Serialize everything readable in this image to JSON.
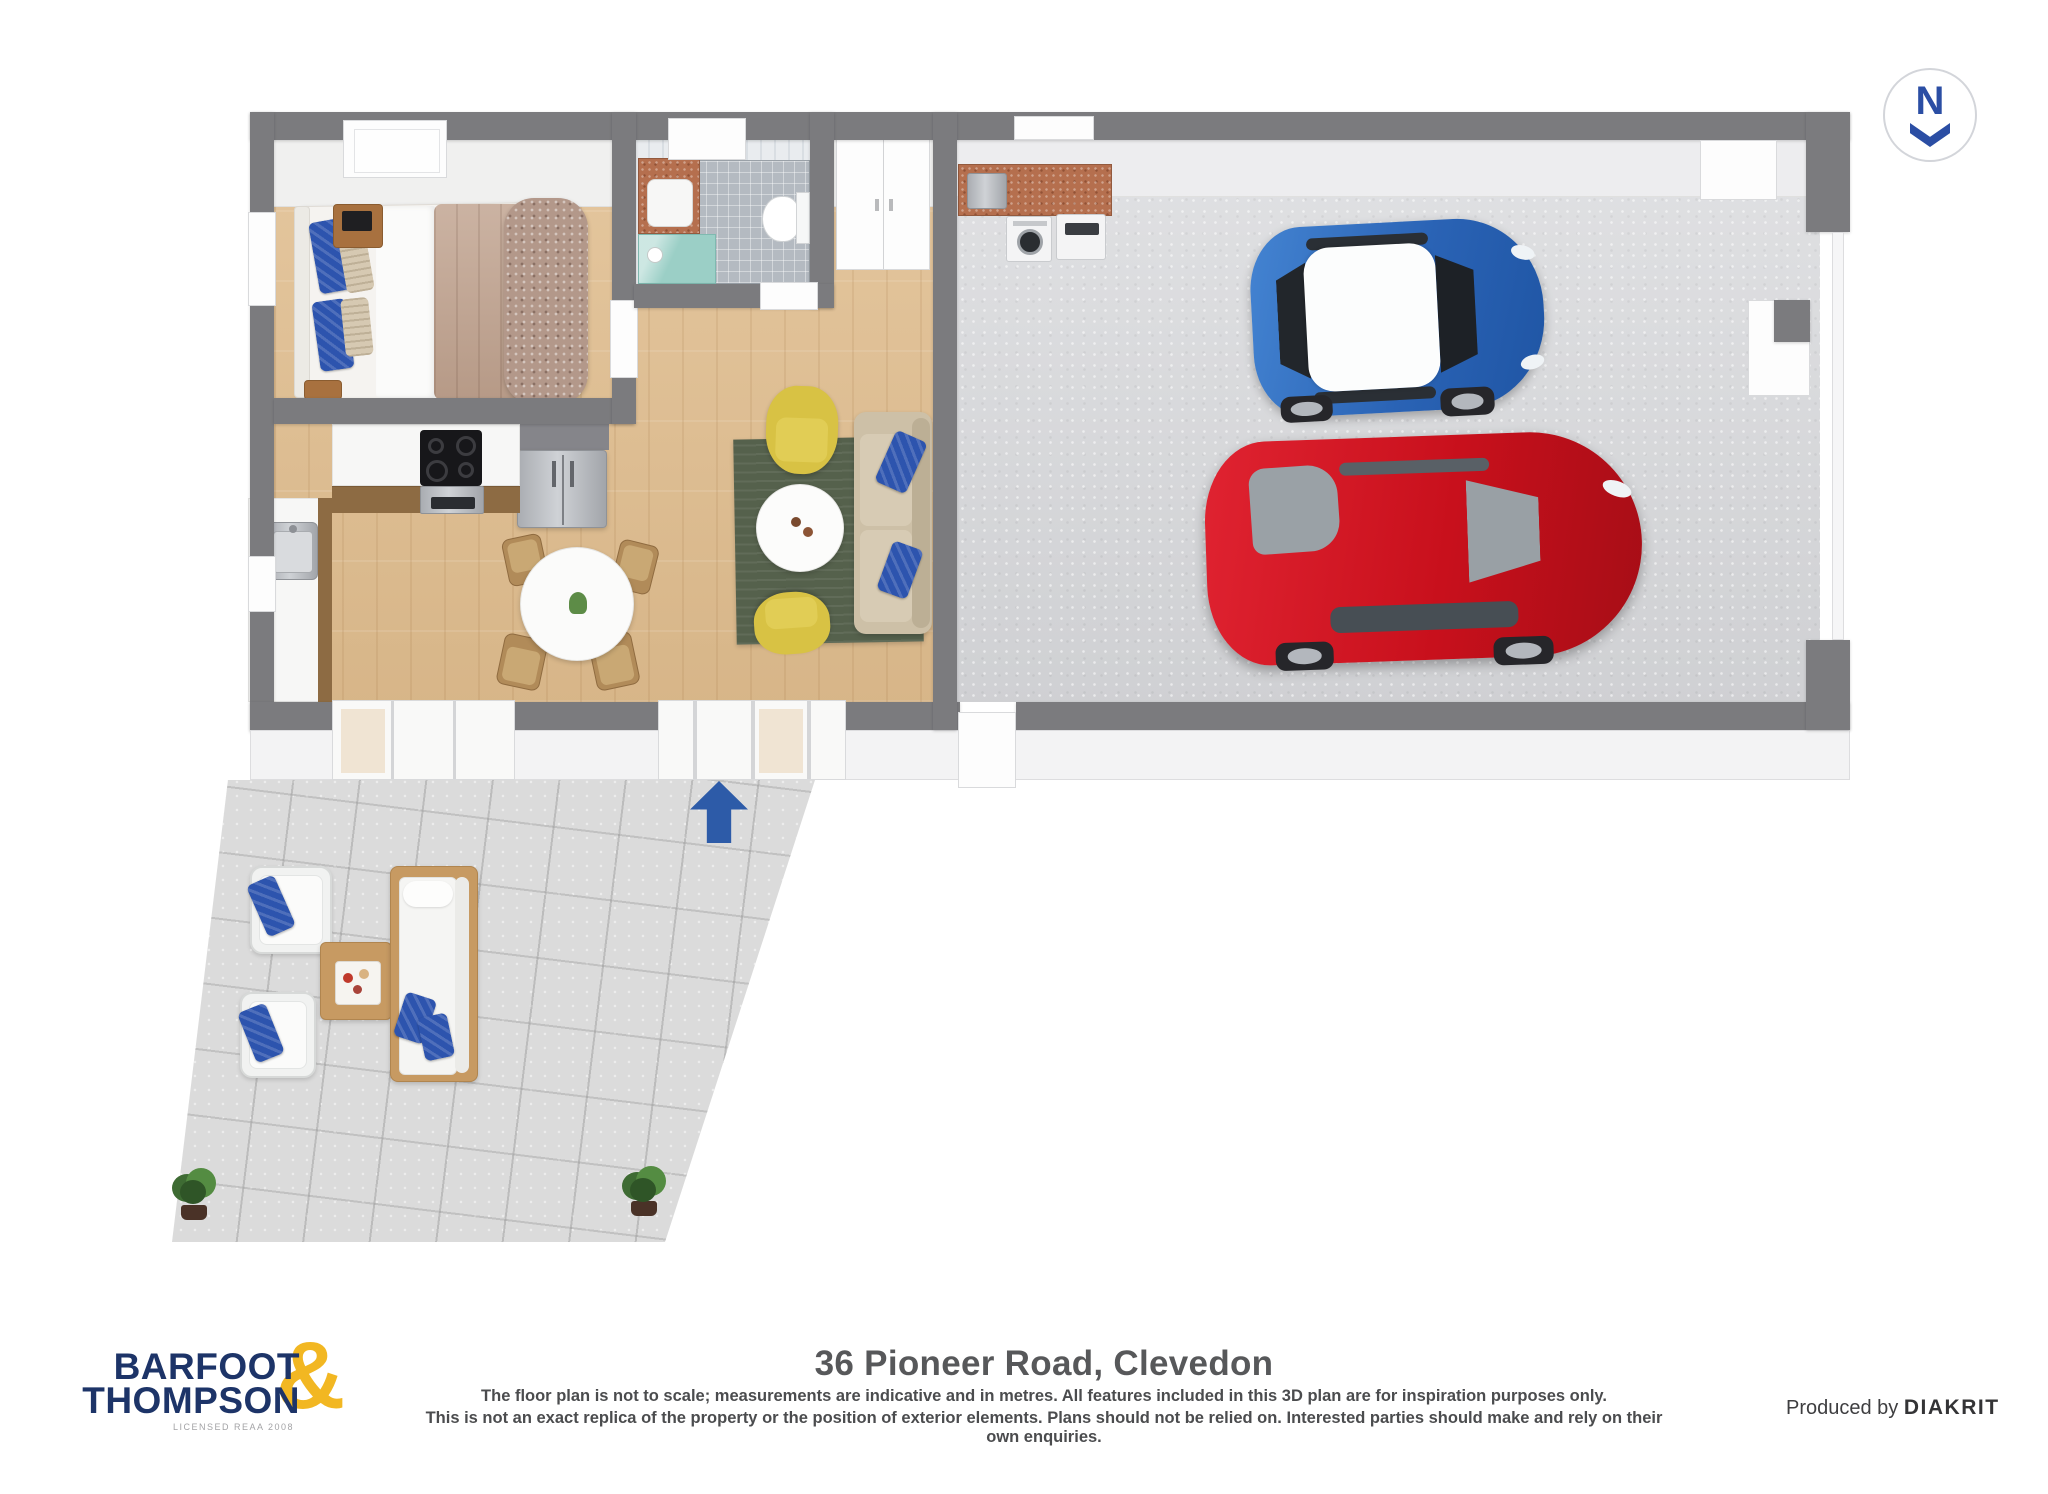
{
  "compass": {
    "letter": "N",
    "direction": "down",
    "color": "#2b4ea4"
  },
  "entrance_arrow": {
    "direction": "up",
    "color": "#2d5ba8"
  },
  "floorplan": {
    "rooms": [
      "bedroom",
      "bathroom",
      "wardrobe",
      "kitchen",
      "dining-area",
      "living-area",
      "laundry-nook",
      "double-garage",
      "patio"
    ],
    "vehicles": [
      "blue-hatchback-white-roof",
      "red-sedan"
    ],
    "colors": {
      "wall": "#7b7b7e",
      "wood_floor": "#e0bd8e",
      "garage_floor": "#d6d7da",
      "patio_tile": "#dbdbdb",
      "rug_green": "#55614c",
      "armchair_yellow": "#d8c244",
      "sofa_tan": "#cdc0a7",
      "pillow_blue": "#2d54ae",
      "bed_duvet": "#c0a28e",
      "counter_copper": "#b56f4e",
      "shower_teal": "#9bcfc6",
      "car_blue": "#2a63b5",
      "car_red": "#c8101c"
    }
  },
  "footer": {
    "logo": {
      "line1": "BARFOOT",
      "line2": "THOMPSON",
      "ampersand": "&",
      "license": "LICENSED REAA 2008",
      "navy": "#1d3468",
      "gold": "#f2b722"
    },
    "title": "36 Pioneer Road, Clevedon",
    "disclaimer_line1": "The floor plan is not to scale; measurements are indicative and in metres. All features included in this 3D plan are for inspiration purposes only.",
    "disclaimer_line2": "This is not an exact replica of the property or the position of exterior elements. Plans should not be relied on. Interested parties should make and rely on their own enquiries.",
    "produced_by_label": "Produced by",
    "producer_name": "DIAKRIT"
  }
}
